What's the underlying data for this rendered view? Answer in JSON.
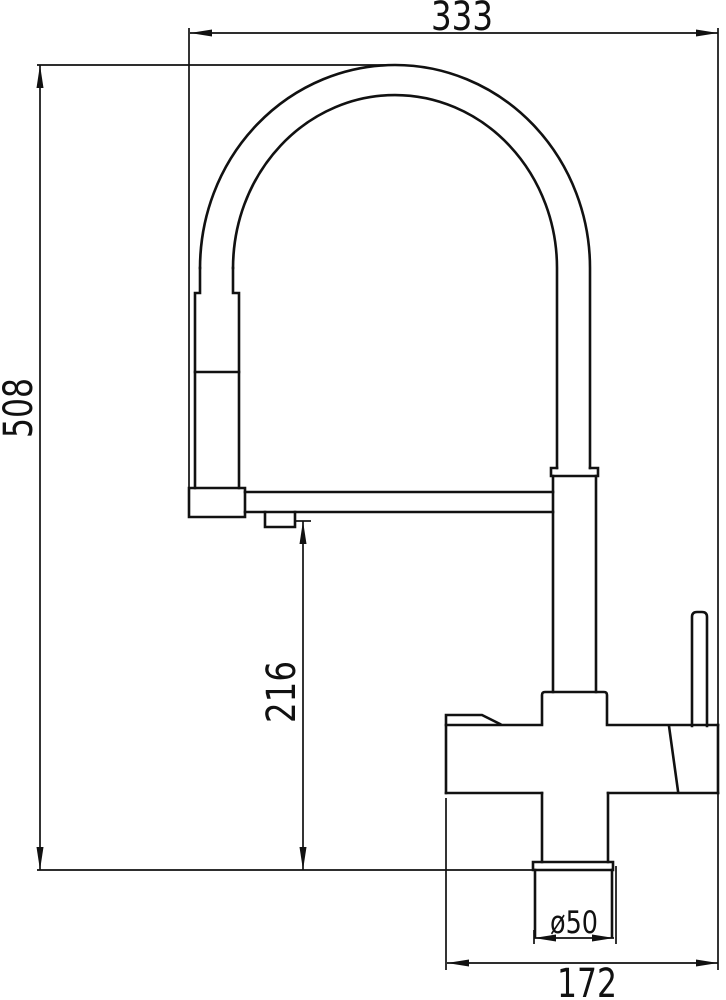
{
  "page": {
    "background": "#ffffff",
    "line_color": "#111111"
  },
  "drawing": {
    "kind": "faucet-technical-drawing",
    "dims": {
      "overall_width": {
        "value": "333",
        "orientation": "horizontal-top"
      },
      "overall_height": {
        "value": "508",
        "orientation": "vertical-left"
      },
      "spout_clearance": {
        "value": "216",
        "orientation": "vertical-middle"
      },
      "base_diameter": {
        "value": "ø50",
        "orientation": "horizontal-bottom"
      },
      "footprint_width": {
        "value": "172",
        "orientation": "horizontal-bottom"
      }
    }
  }
}
